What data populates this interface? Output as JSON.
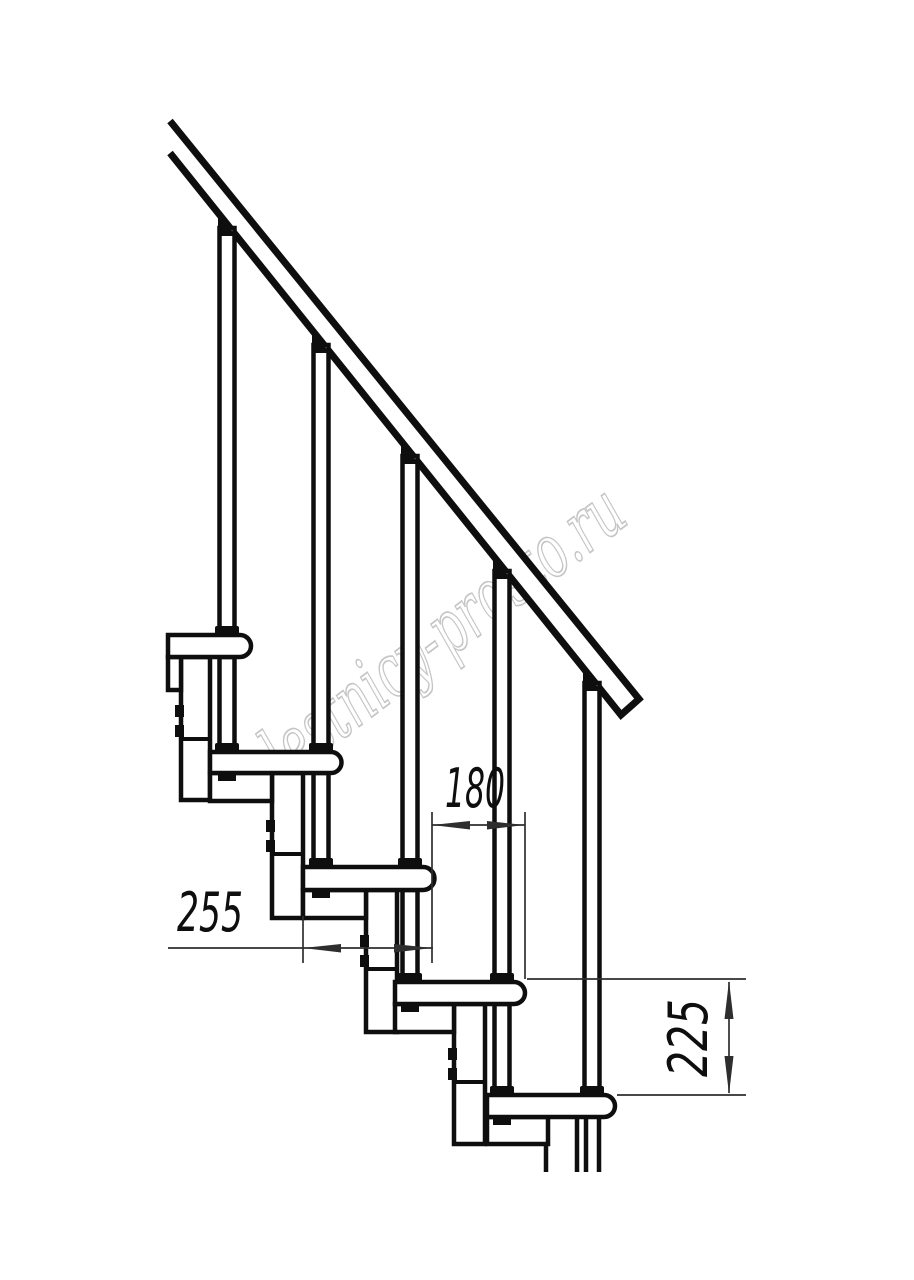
{
  "watermark": {
    "text": "lestnicy-prosto.ru",
    "color": "#c5c5c5"
  },
  "dimensions": {
    "tread_depth": "255",
    "step_run": "180",
    "step_rise": "225"
  },
  "colors": {
    "line": "#0e0e0e",
    "thin_line": "#2e2e2e",
    "background": "#ffffff"
  }
}
